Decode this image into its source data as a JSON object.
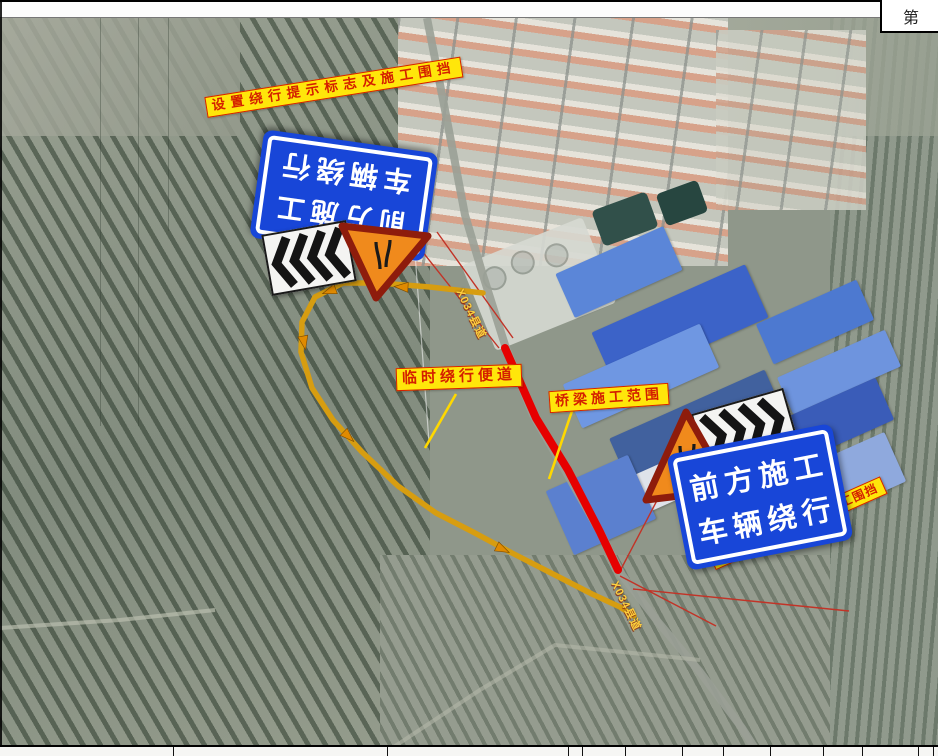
{
  "drawing": {
    "title_block_char": "第",
    "colors": {
      "sign_blue": "#1846d8",
      "warning_orange": "#f08a1c",
      "warning_border_red": "#8e1c0c",
      "label_yellow": "#ffe60a",
      "label_red": "#d41f00",
      "detour_route_orange": "#d79d10",
      "closed_section_red": "#e60000"
    }
  },
  "annotations": {
    "setup_sign_top": "设置绕行提示标志及施工围挡",
    "temporary_detour": "临时绕行便道",
    "bridge_construction_area": "桥梁施工范围",
    "setup_sign_bottom": "设置绕行提示标志及施工围挡",
    "road_label_north": "X034县道",
    "road_label_south": "X034县道"
  },
  "signs": {
    "blue_sign_top": {
      "line1": "前方施工",
      "line2": "车辆绕行"
    },
    "blue_sign_bottom": {
      "line1": "前方施工",
      "line2": "车辆绕行"
    }
  }
}
